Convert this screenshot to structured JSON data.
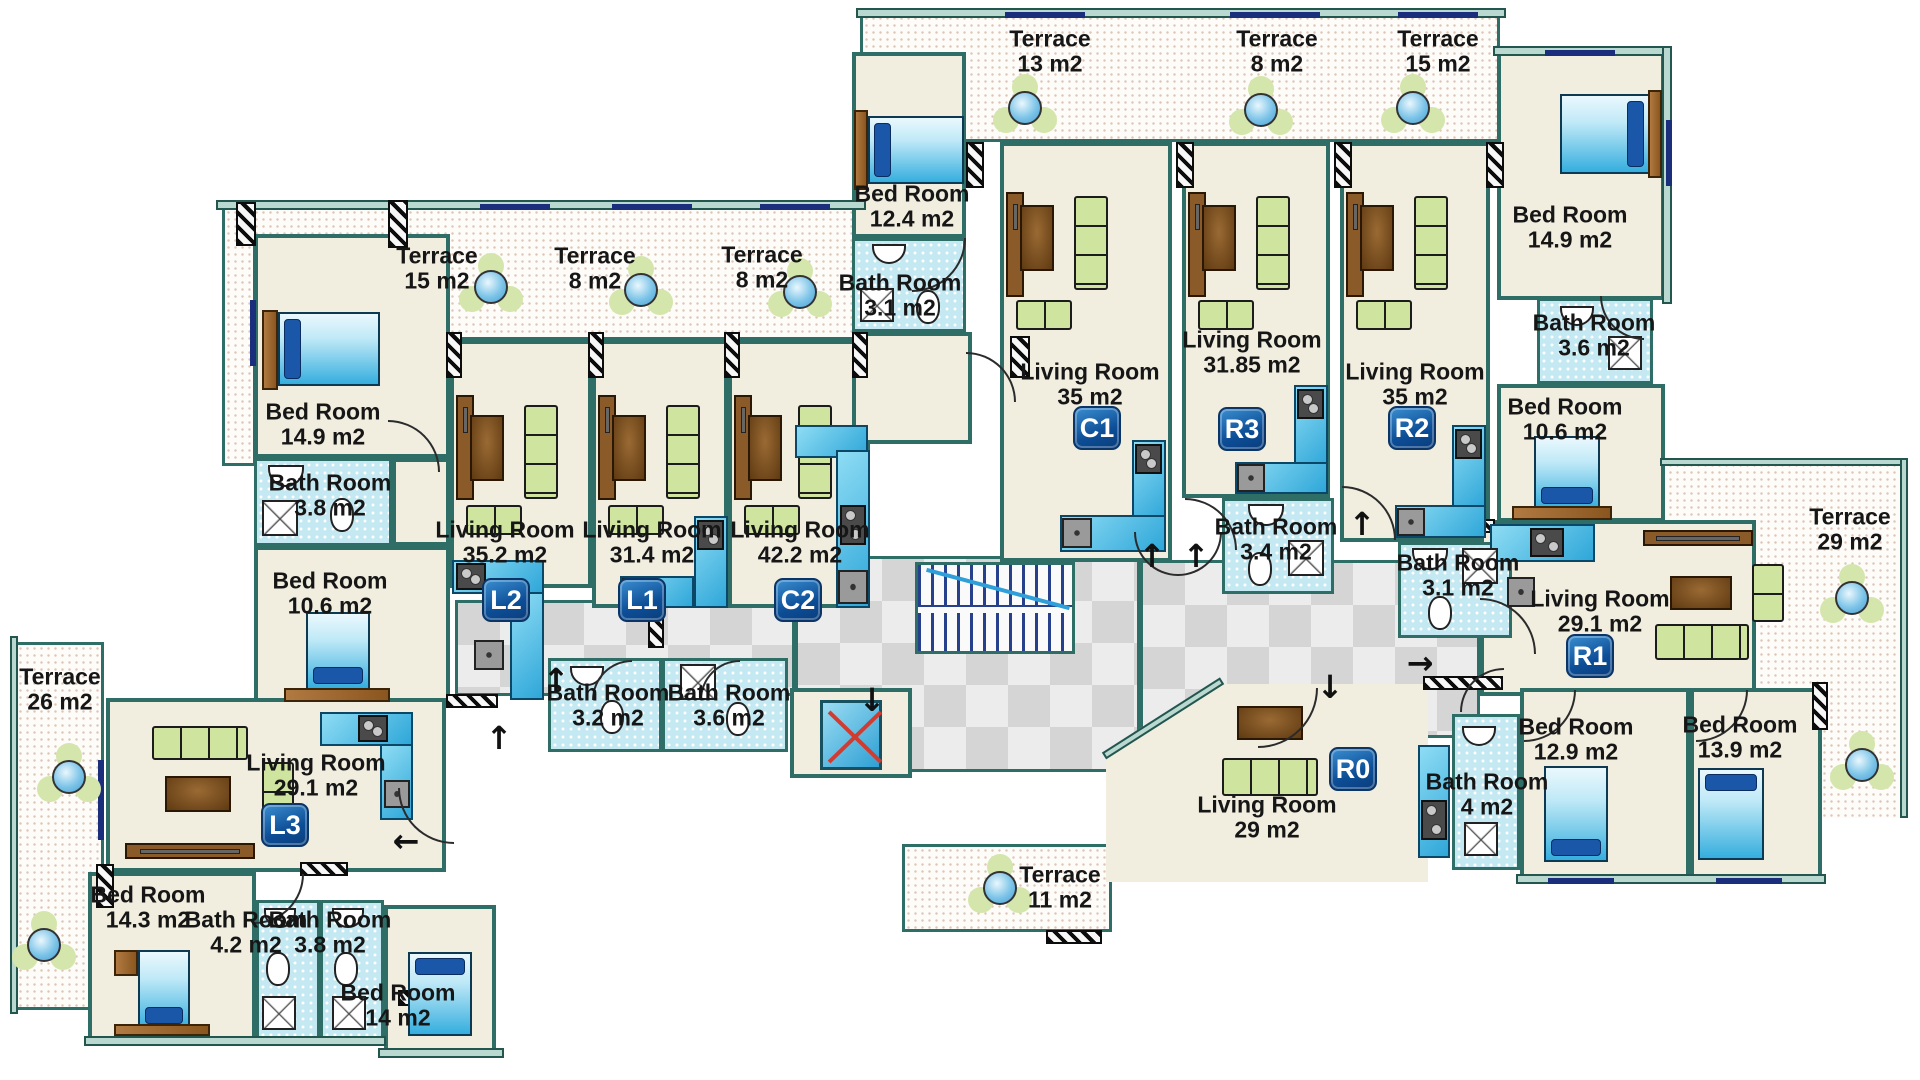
{
  "units": {
    "l1": "L1",
    "l2": "L2",
    "l3": "L3",
    "c1": "C1",
    "c2": "C2",
    "r0": "R0",
    "r1": "R1",
    "r2": "R2",
    "r3": "R3"
  },
  "arrows": {
    "up": "↑",
    "down": "↓",
    "left": "←",
    "right": "→"
  },
  "labels": [
    {
      "name": "Terrace",
      "area": "15 m2"
    },
    {
      "name": "Terrace",
      "area": "8 m2"
    },
    {
      "name": "Terrace",
      "area": "8 m2"
    },
    {
      "name": "Terrace",
      "area": "13 m2"
    },
    {
      "name": "Terrace",
      "area": "8 m2"
    },
    {
      "name": "Terrace",
      "area": "15 m2"
    },
    {
      "name": "Bed Room",
      "area": "12.4 m2"
    },
    {
      "name": "Bath Room",
      "area": "3.1 m2"
    },
    {
      "name": "Living Room",
      "area": "35  m2"
    },
    {
      "name": "Living Room",
      "area": "31.85 m2"
    },
    {
      "name": "Living Room",
      "area": "35 m2"
    },
    {
      "name": "Bed Room",
      "area": "14.9 m2"
    },
    {
      "name": "Bath Room",
      "area": "3.6 m2"
    },
    {
      "name": "Bed Room",
      "area": "10.6 m2"
    },
    {
      "name": "Bath Room",
      "area": "3.4 m2"
    },
    {
      "name": "Bath Room",
      "area": "3.1 m2"
    },
    {
      "name": "Living Room",
      "area": "29.1 m2"
    },
    {
      "name": "Terrace",
      "area": "29 m2"
    },
    {
      "name": "Living Room",
      "area": "29 m2"
    },
    {
      "name": "Bath Room",
      "area": "4 m2"
    },
    {
      "name": "Bed Room",
      "area": "12.9 m2"
    },
    {
      "name": "Bed Room",
      "area": "13.9 m2"
    },
    {
      "name": "Terrace",
      "area": "11 m2"
    },
    {
      "name": "Bed Room",
      "area": "14.9 m2"
    },
    {
      "name": "Bath Room",
      "area": "3.8 m2"
    },
    {
      "name": "Bed Room",
      "area": "10.6 m2"
    },
    {
      "name": "Living Room",
      "area": "35.2  m2"
    },
    {
      "name": "Living Room",
      "area": "31.4  m2"
    },
    {
      "name": "Living Room",
      "area": "42.2  m2"
    },
    {
      "name": "Bath Room",
      "area": "3.2 m2"
    },
    {
      "name": "Bath Room",
      "area": "3.6 m2"
    },
    {
      "name": "Terrace",
      "area": "26 m2"
    },
    {
      "name": "Living Room",
      "area": "29.1 m2"
    },
    {
      "name": "Bed Room",
      "area": "14.3 m2"
    },
    {
      "name": "Bath Room",
      "area": "4.2 m2"
    },
    {
      "name": "Bath Room",
      "area": "3.8 m2"
    },
    {
      "name": "Bed Room",
      "area": "14 m2"
    }
  ]
}
